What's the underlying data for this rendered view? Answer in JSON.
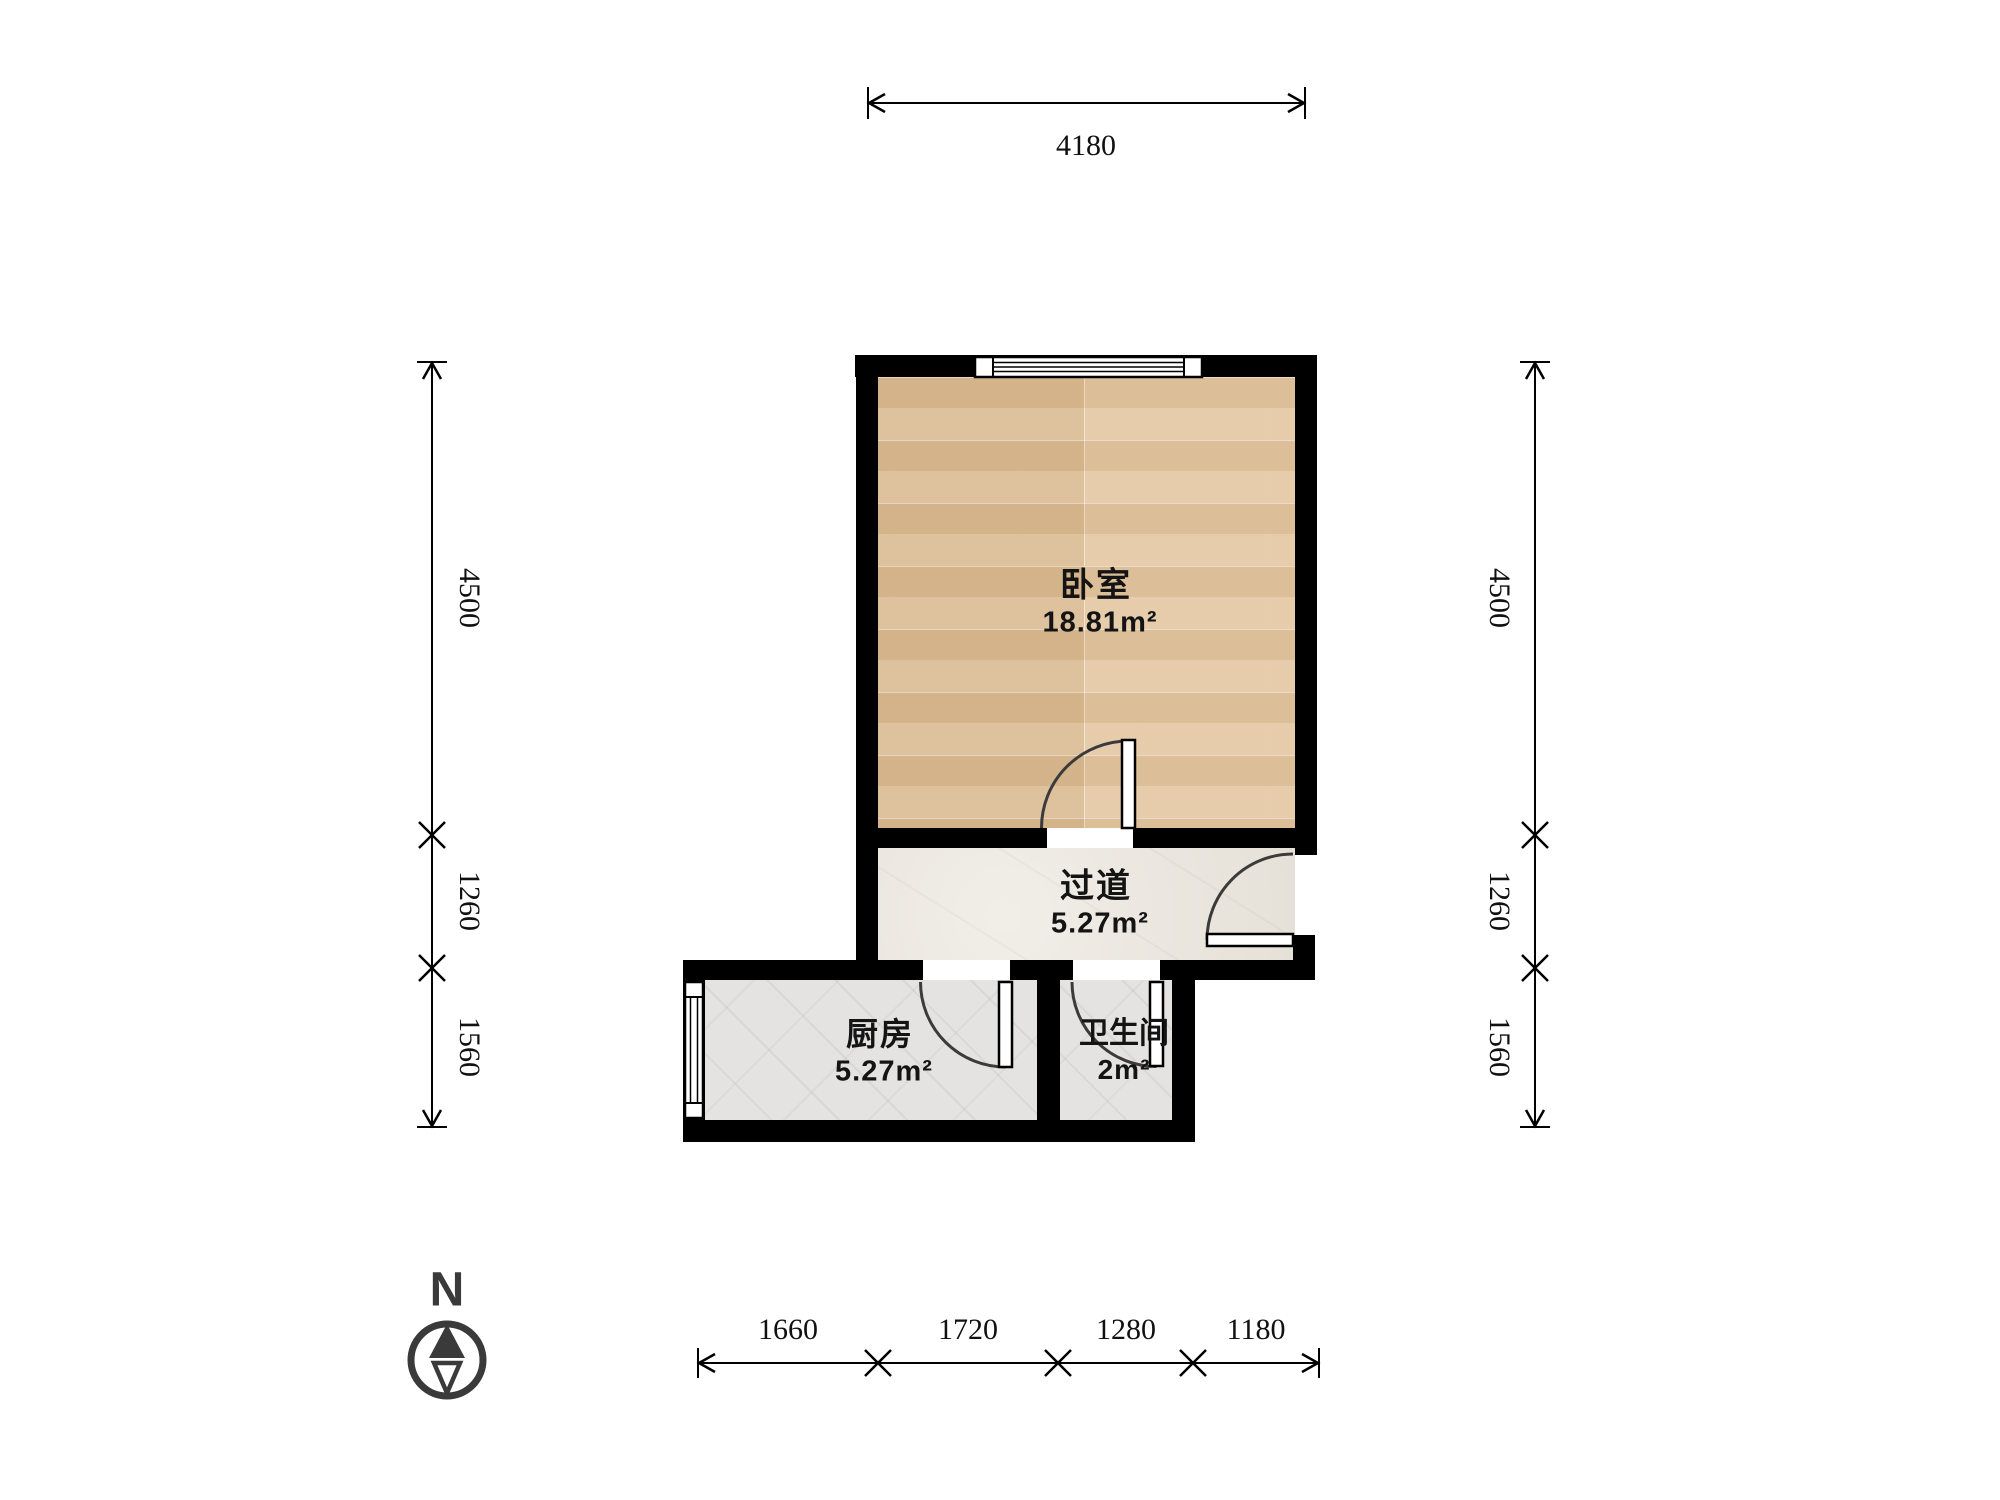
{
  "compass": {
    "label": "N"
  },
  "rooms": [
    {
      "id": "bedroom",
      "name": "卧室",
      "area": "18.81m²"
    },
    {
      "id": "hallway",
      "name": "过道",
      "area": "5.27m²"
    },
    {
      "id": "kitchen",
      "name": "厨房",
      "area": "5.27m²"
    },
    {
      "id": "bathroom",
      "name": "卫生间",
      "area": "2m²"
    }
  ],
  "dimensions": {
    "top": [
      "4180"
    ],
    "left": [
      "4500",
      "1260",
      "1560"
    ],
    "right": [
      "4500",
      "1260",
      "1560"
    ],
    "bottom": [
      "1660",
      "1720",
      "1280",
      "1180"
    ]
  },
  "colors": {
    "wall": "#000000",
    "wood_floor": "#dfc19a",
    "stone_floor": "#eae5dc",
    "tile_floor": "#e4e3e1",
    "dimension_ink": "#111111",
    "compass_ink": "#3a3a3a"
  }
}
